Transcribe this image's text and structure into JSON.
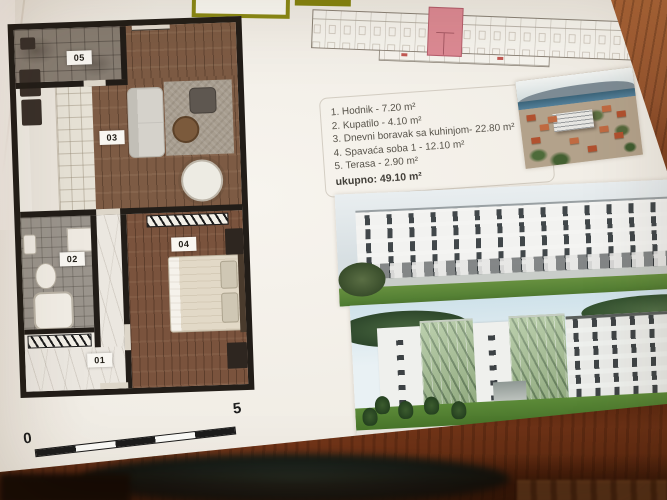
{
  "floor_plan": {
    "rooms": [
      {
        "label": "01"
      },
      {
        "label": "02"
      },
      {
        "label": "03"
      },
      {
        "label": "04"
      },
      {
        "label": "05"
      }
    ],
    "scale_bar": {
      "start": "0",
      "end": "5"
    }
  },
  "unit_info": {
    "lines": [
      "1. Hodnik - 7.20 m²",
      "2. Kupatilo - 4.10 m²",
      "3. Dnevni boravak sa kuhinjom- 22.80 m²",
      "4. Spavaća soba 1 - 12.10 m²",
      "5. Terasa - 2.90 m²"
    ],
    "total": "ukupno: 49.10 m²"
  },
  "site_plan": {
    "highlight_color": "#dd8a94"
  },
  "colors": {
    "olive_header": "#85840f",
    "plan_wall": "#221d18",
    "desk_wood": "#7a3c1c",
    "text": "#57534a"
  }
}
